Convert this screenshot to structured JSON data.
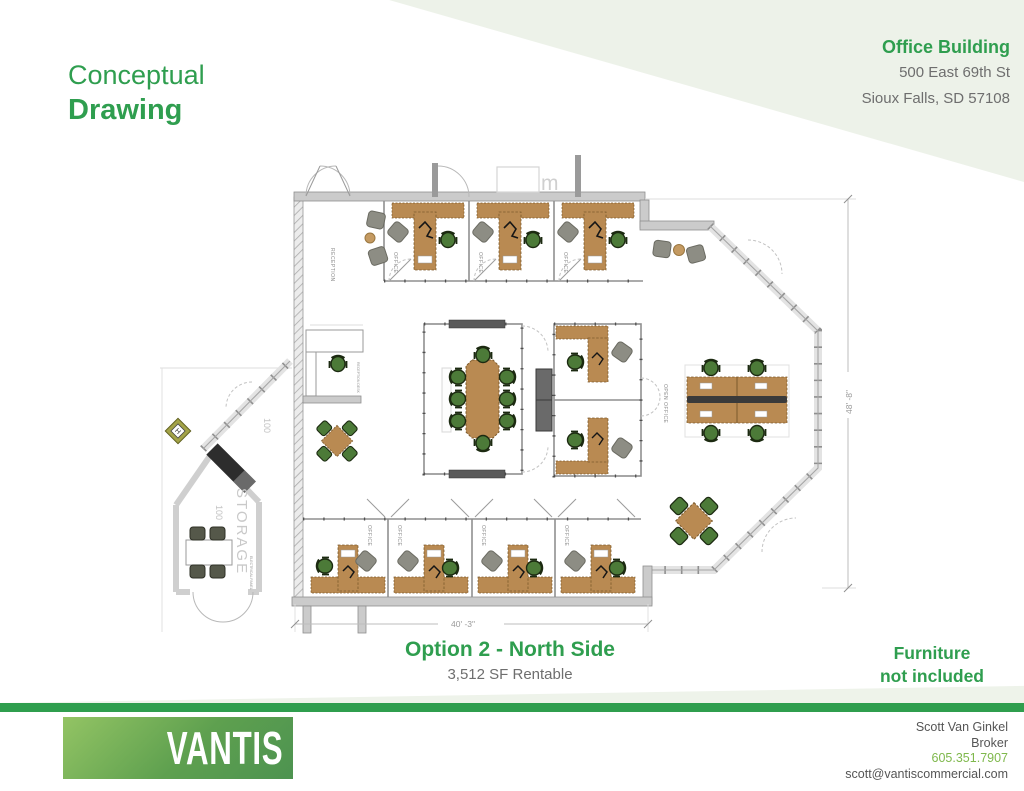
{
  "header": {
    "title_line1": "Conceptual",
    "title_line2": "Drawing",
    "building_name": "Office Building",
    "address_line1": "500 East 69th St",
    "address_line2": "Sioux Falls, SD 57108"
  },
  "caption": {
    "option_title": "Option 2 - North Side",
    "area": "3,512 SF Rentable",
    "furniture_line1": "Furniture",
    "furniture_line2": "not included"
  },
  "footer": {
    "logo_text": "VANTIS",
    "contact_name": "Scott Van Ginkel",
    "contact_role": "Broker",
    "contact_phone": "605.351.7907",
    "contact_email": "scott@vantiscommercial.com"
  },
  "plan": {
    "labels": {
      "reception": "RECEPTION",
      "office": "OFFICE",
      "open_office": "OPEN OFFICE",
      "storage": "STORAGE",
      "room_number": "100",
      "reception_desk": "RECEPTION DESK",
      "electrical_panel": "ELECTRICAL PANEL",
      "marker": "H",
      "fixture": "m"
    },
    "dimensions": {
      "width": "40' -3\"",
      "height": "48' -8\""
    }
  },
  "colors": {
    "brand_green": "#2f9e4f",
    "light_green": "#7fb84c",
    "pale_green": "#edf2e9",
    "text_gray": "#6e6e6e",
    "desk_brown": "#b98a52",
    "chair_green": "#4c7a38",
    "wall_gray": "#cbcbcb"
  }
}
